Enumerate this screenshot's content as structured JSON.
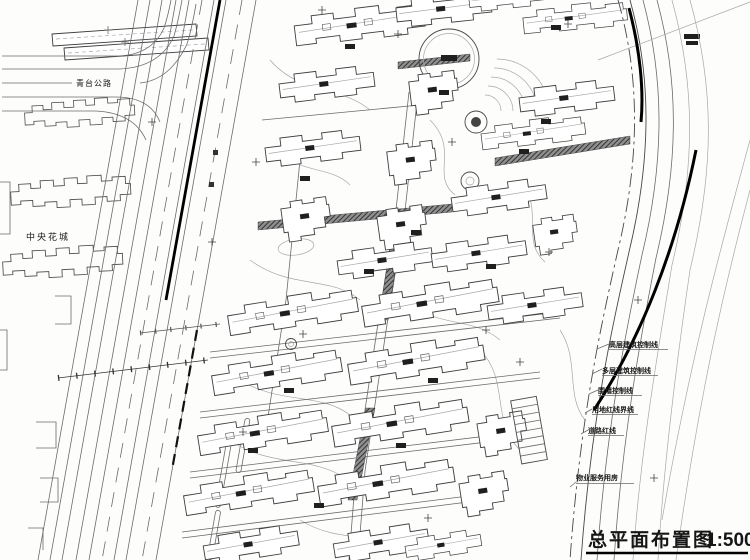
{
  "drawing": {
    "type": "architectural-site-plan",
    "paper_color": "#fdfdfc",
    "line_color": "#3e3e3e",
    "heavy_line_color": "#000000"
  },
  "title": {
    "text": "总平面布置图",
    "scale": "1:500"
  },
  "site_labels": {
    "top_left_road": "青台公路",
    "west_neighborhood": "中央花城"
  },
  "legend": {
    "items": [
      {
        "label": "高层建筑控制线"
      },
      {
        "label": "多层建筑控制线"
      },
      {
        "label": "围墙控制线"
      },
      {
        "label": "用地红线界线"
      },
      {
        "label": "道路红线"
      }
    ],
    "service_building_label": "物业服务用房"
  }
}
